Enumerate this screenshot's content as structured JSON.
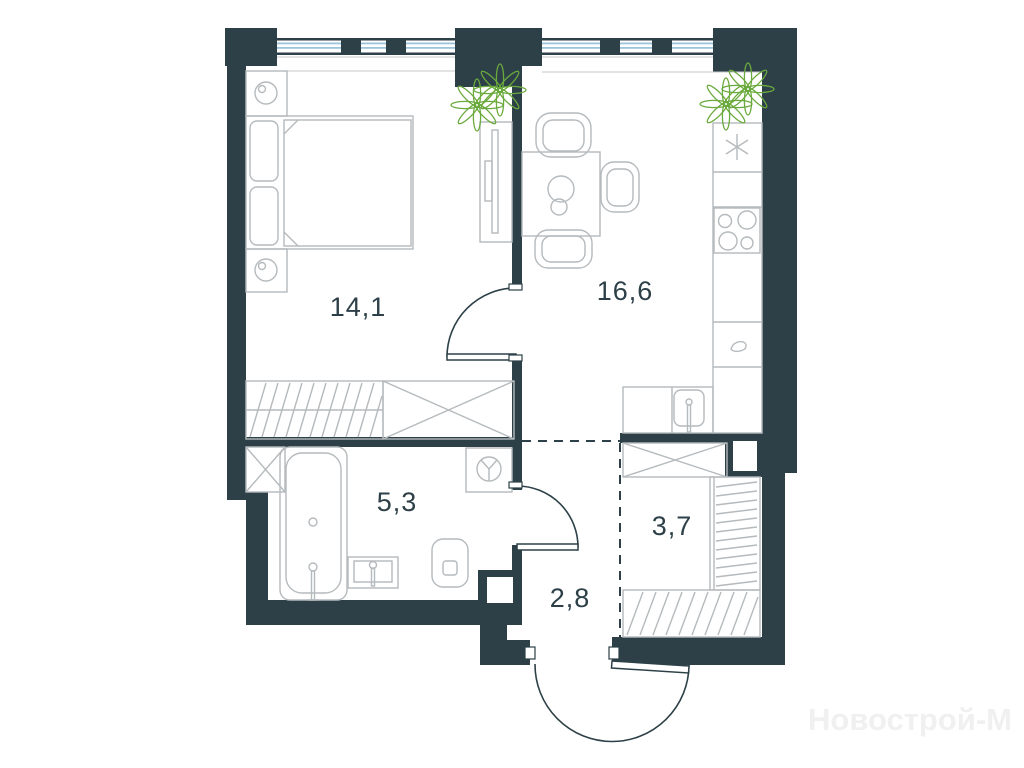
{
  "plan": {
    "title": "apartment-floor-plan",
    "watermark": "Новострой-М",
    "rooms": [
      {
        "name": "bedroom",
        "area_label": "14,1"
      },
      {
        "name": "kitchen-living-room",
        "area_label": "16,6"
      },
      {
        "name": "bathroom",
        "area_label": "5,3"
      },
      {
        "name": "wardrobe-room",
        "area_label": "3,7"
      },
      {
        "name": "hallway",
        "area_label": "2,8"
      }
    ],
    "colors": {
      "wall": "#2d4048",
      "window_glass": "#9cc4dd",
      "furniture_line": "#b5babd",
      "plant": "#6aaa3c",
      "watermark": "#f0f0f0",
      "background": "#ffffff"
    },
    "icons": [
      "bed",
      "pillow",
      "nightstand-lamp",
      "tv-console",
      "plant",
      "dining-table",
      "chair",
      "cooktop",
      "extractor-asterisk",
      "cabinet-handle",
      "kitchen-sink",
      "bathtub",
      "wash-basin",
      "toilet",
      "washing-machine",
      "wardrobe-x",
      "wardrobe-hanger",
      "shoe-rack-hatch",
      "door-swing",
      "entrance-door"
    ]
  }
}
